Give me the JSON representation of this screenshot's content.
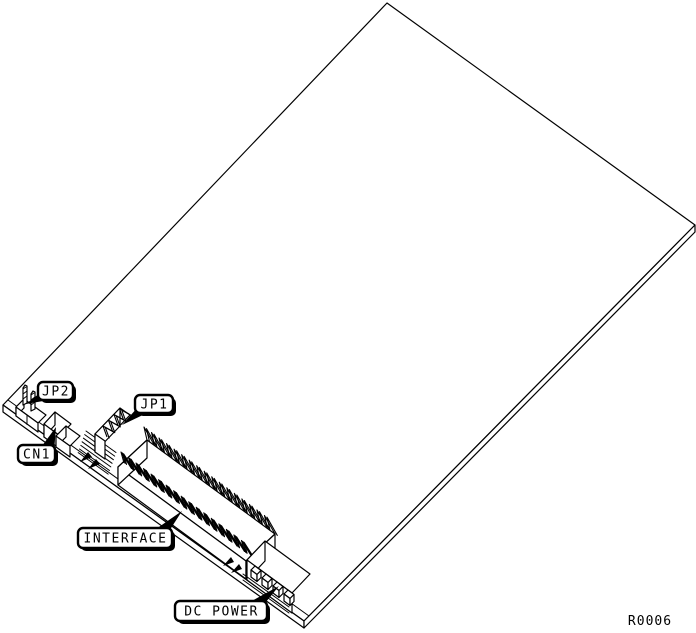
{
  "colors": {
    "line": "#000000",
    "background": "#ffffff"
  },
  "figure": {
    "kind": "isometric line drawing of a circuit board",
    "drawing_number": "R0006",
    "callouts": [
      {
        "id": "jp2",
        "label": "JP2",
        "component": "two-pin-jumper-header"
      },
      {
        "id": "jp1",
        "label": "JP1",
        "component": "four-pin-jumper-header"
      },
      {
        "id": "cn1",
        "label": "CN1",
        "component": "small-connector"
      },
      {
        "id": "interface",
        "label": "INTERFACE",
        "component": "dual-row-interface-pin-header"
      },
      {
        "id": "dc-power",
        "label": "DC POWER",
        "component": "four-pin-dc-power-connector"
      }
    ]
  }
}
